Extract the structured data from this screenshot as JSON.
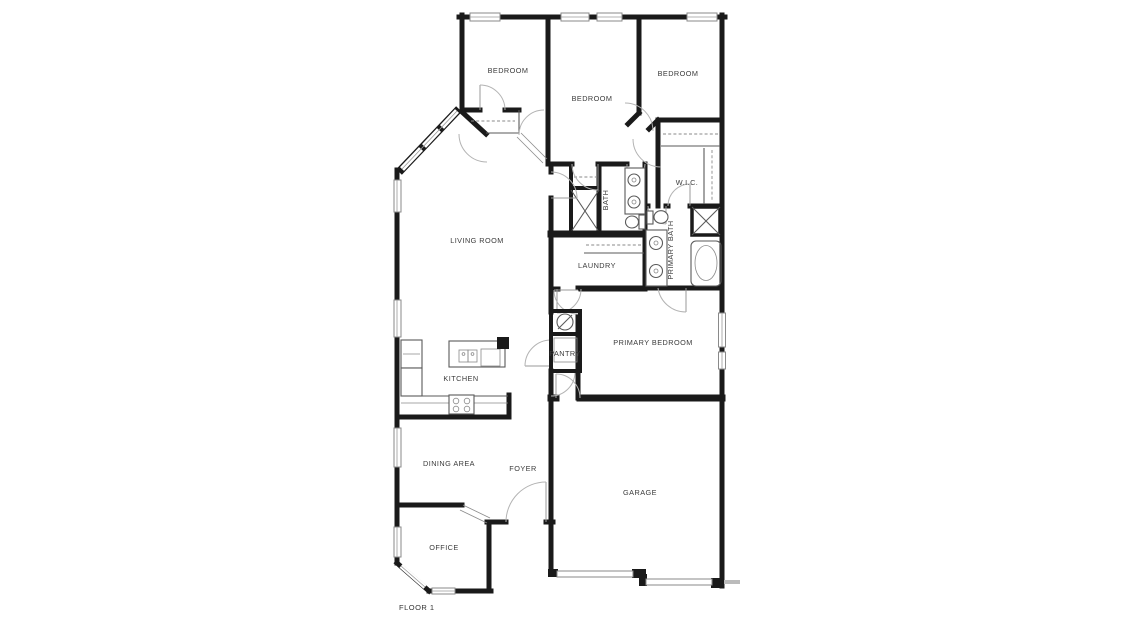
{
  "plan": {
    "floor_label": "FLOOR 1",
    "colors": {
      "wall": "#1a1a1a",
      "fixture_line": "#5a5a5a",
      "door_arc": "#b3b3b3",
      "window_stroke": "#8a8a8a",
      "label_text": "#3b3b3b",
      "background": "#ffffff"
    },
    "rooms": [
      {
        "id": "bedroom-top-left",
        "label": "BEDROOM"
      },
      {
        "id": "bedroom-top-middle",
        "label": "BEDROOM"
      },
      {
        "id": "bedroom-top-right",
        "label": "BEDROOM"
      },
      {
        "id": "wic",
        "label": "W.I.C."
      },
      {
        "id": "bath",
        "label": "BATH"
      },
      {
        "id": "primary-bath",
        "label": "PRIMARY BATH"
      },
      {
        "id": "laundry",
        "label": "LAUNDRY"
      },
      {
        "id": "living-room",
        "label": "LIVING ROOM"
      },
      {
        "id": "kitchen",
        "label": "KITCHEN"
      },
      {
        "id": "pantry",
        "label": "PANTRY"
      },
      {
        "id": "primary-bedroom",
        "label": "PRIMARY BEDROOM"
      },
      {
        "id": "dining-area",
        "label": "DINING AREA"
      },
      {
        "id": "foyer",
        "label": "FOYER"
      },
      {
        "id": "garage",
        "label": "GARAGE"
      },
      {
        "id": "office",
        "label": "OFFICE"
      }
    ]
  }
}
